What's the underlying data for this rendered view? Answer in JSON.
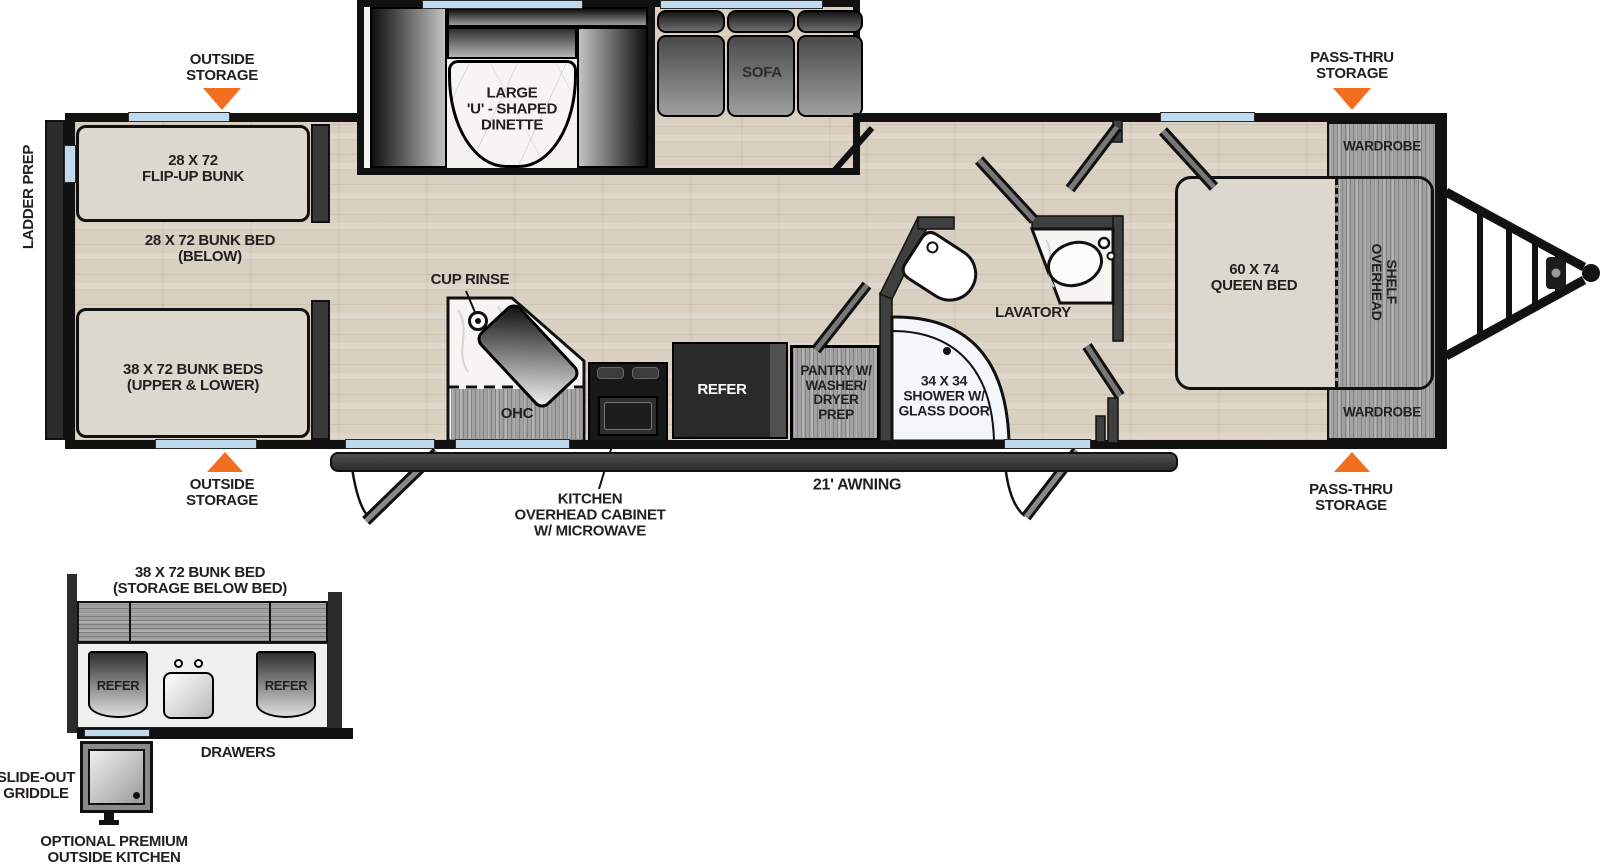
{
  "main": {
    "outside_storage_top": "OUTSIDE\nSTORAGE",
    "outside_storage_bottom": "OUTSIDE\nSTORAGE",
    "pass_thru_top": "PASS-THRU\nSTORAGE",
    "pass_thru_bottom": "PASS-THRU\nSTORAGE",
    "ladder_prep": "LADDER PREP",
    "flip_bunk": "28 X 72\nFLIP-UP BUNK",
    "bunk_below": "28 X 72 BUNK BED\n(BELOW)",
    "bunk_beds": "38 X 72 BUNK BEDS\n(UPPER & LOWER)",
    "dinette": "LARGE\n'U' - SHAPED\nDINETTE",
    "sofa": "SOFA",
    "cup_rinse": "CUP RINSE",
    "ohc": "OHC",
    "refer": "REFER",
    "pantry": "PANTRY W/\nWASHER/\nDRYER\nPREP",
    "shower": "34 X 34\nSHOWER W/\nGLASS DOOR",
    "lavatory": "LAVATORY",
    "queen_bed": "60 X 74\nQUEEN BED",
    "overhead_shelf": "OVERHEAD\nSHELF",
    "wardrobe_top": "WARDROBE",
    "wardrobe_bottom": "WARDROBE",
    "awning": "21' AWNING",
    "kitchen_cabinet": "KITCHEN\nOVERHEAD CABINET\nW/ MICROWAVE"
  },
  "outside_kitchen": {
    "bunk_bed": "38 X 72 BUNK BED\n(STORAGE BELOW BED)",
    "refer_left": "REFER",
    "refer_right": "REFER",
    "drawers": "DRAWERS",
    "griddle": "SLIDE-OUT\nGRIDDLE",
    "title": "OPTIONAL PREMIUM\nOUTSIDE KITCHEN"
  },
  "colors": {
    "accent_orange": "#F26E21",
    "window_blue": "#BFD9EE",
    "wall": "#111111"
  }
}
